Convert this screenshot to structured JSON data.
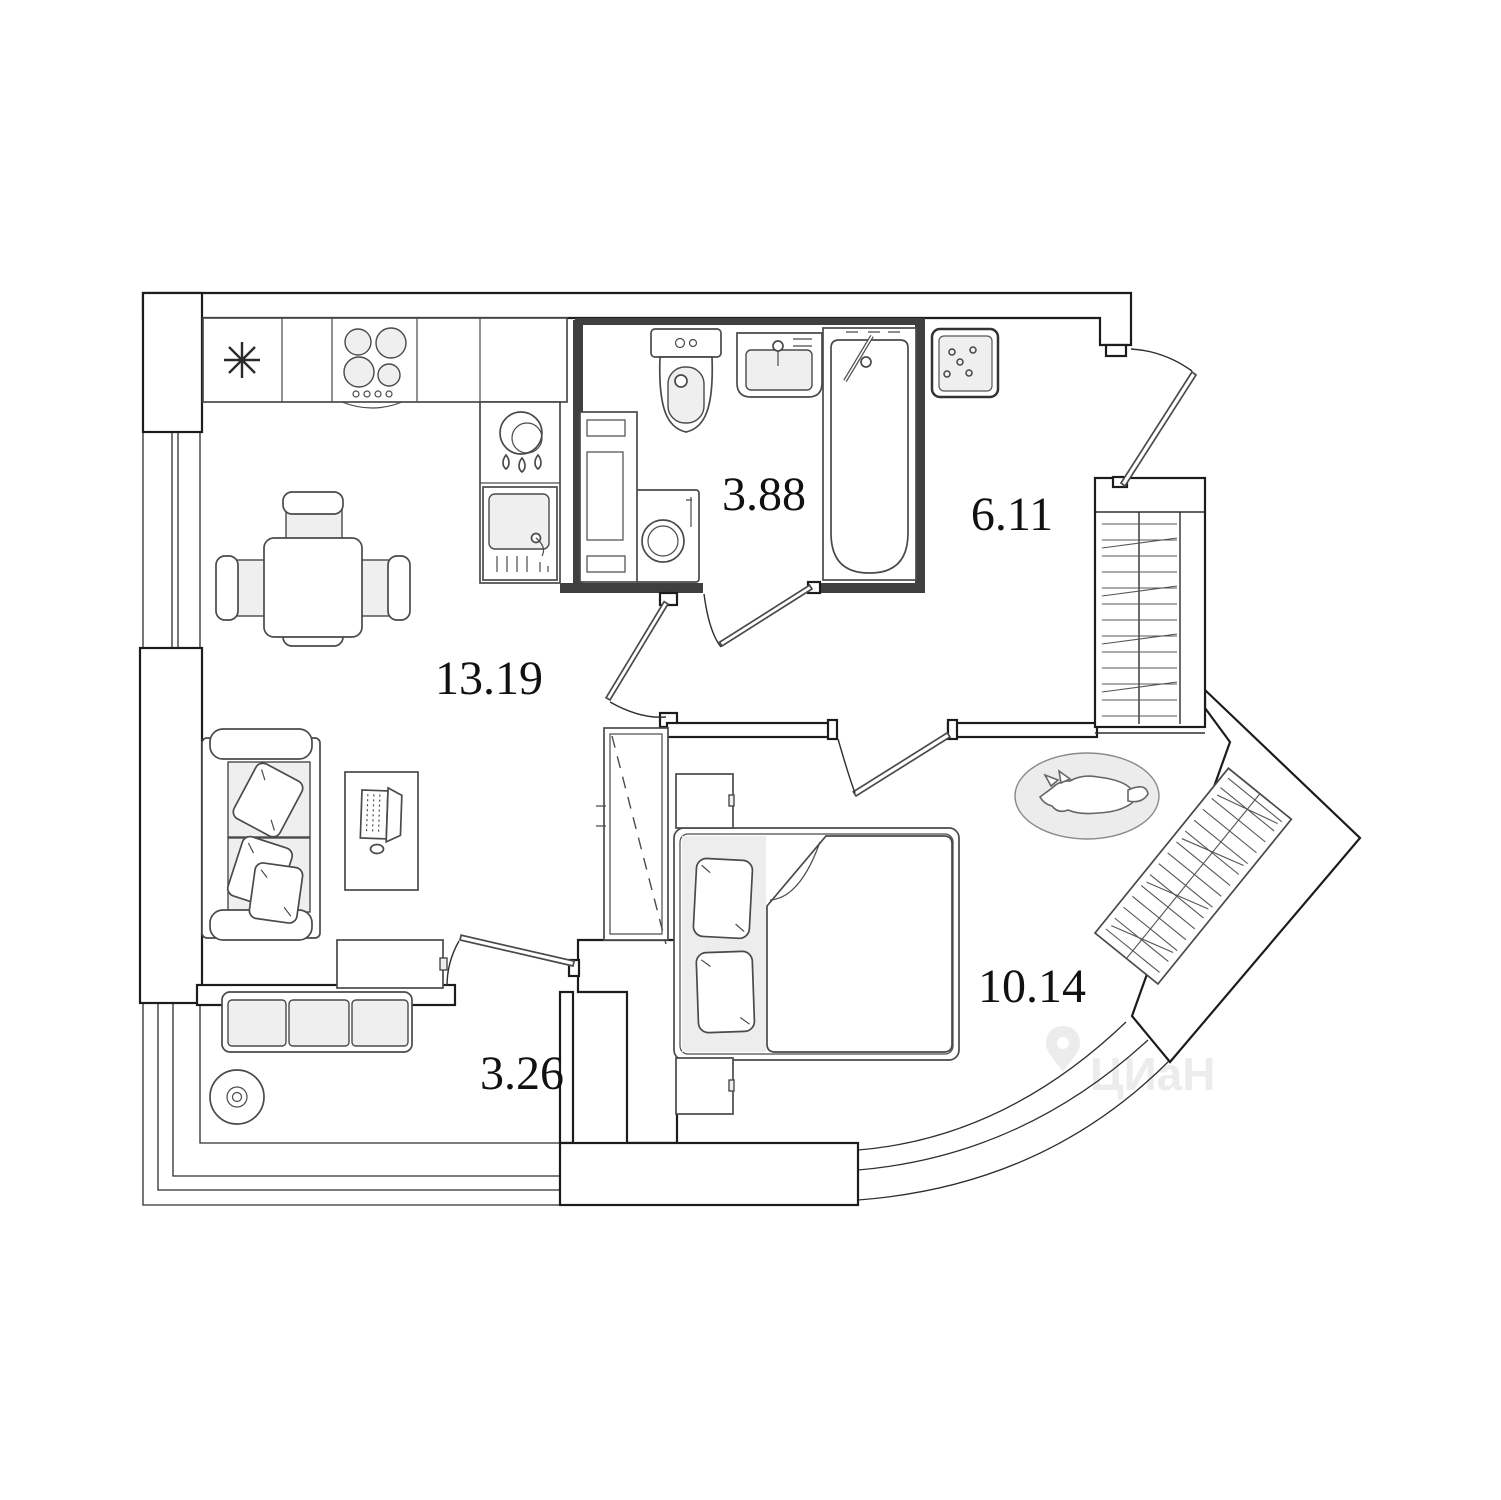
{
  "plan": {
    "title": "apartment-floor-plan",
    "rooms": [
      {
        "id": "kitchen-living",
        "area": "13.19"
      },
      {
        "id": "bathroom",
        "area": "3.88"
      },
      {
        "id": "hallway",
        "area": "6.11"
      },
      {
        "id": "bedroom",
        "area": "10.14"
      },
      {
        "id": "balcony",
        "area": "3.26"
      }
    ],
    "fixtures": [
      "fridge-asterisk",
      "stove-burners",
      "water-heater",
      "kitchen-sink",
      "dining-table",
      "dining-chairs",
      "sofa",
      "desk-with-laptop",
      "tv-cabinet",
      "balcony-bench",
      "flower-pot",
      "toilet",
      "washbasin",
      "bathtub",
      "washing-machine",
      "shelf-cabinet",
      "vent-shaft",
      "hallway-wardrobe",
      "bedroom-wardrobe",
      "sliding-wardrobe",
      "double-bed",
      "nightstands",
      "pet-bed",
      "entry-door",
      "bathroom-door",
      "living-room-door",
      "bedroom-door",
      "balcony-door",
      "bay-window",
      "left-window"
    ],
    "colors": {
      "wall": "#1c1c1c",
      "bathroom_wall": "#3f3f3f",
      "furniture_line": "#4a4a4a",
      "light_fill": "#efefef",
      "label": "#111111",
      "watermark": "#ececec",
      "background": "#ffffff"
    }
  },
  "watermark": {
    "text": "ЦИаН"
  }
}
